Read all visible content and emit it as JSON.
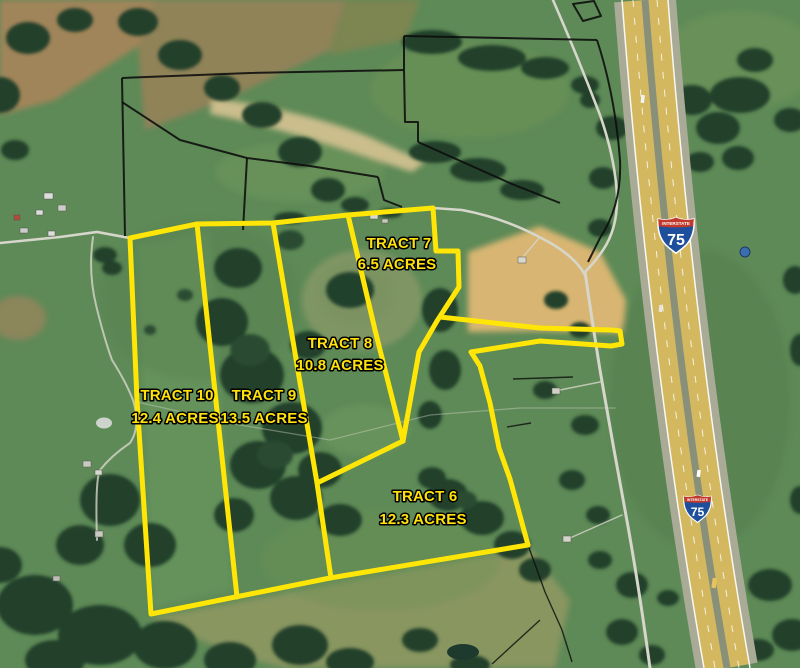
{
  "map": {
    "title": "Aerial plat map of auction tracts along Interstate 75",
    "boundary_color": "#ffe606",
    "parcel_line_color": "#0d0d0d",
    "label_color": "#ffe20a",
    "tracts": [
      {
        "name": "TRACT 7",
        "acres": "6.5 ACRES"
      },
      {
        "name": "TRACT 8",
        "acres": "10.8 ACRES"
      },
      {
        "name": "TRACT 10",
        "acres": "12.4 ACRES"
      },
      {
        "name": "TRACT 9",
        "acres": "13.5 ACRES"
      },
      {
        "name": "TRACT 6",
        "acres": "12.3 ACRES"
      }
    ],
    "highway": {
      "route": "75",
      "shield_header": "INTERSTATE"
    }
  }
}
